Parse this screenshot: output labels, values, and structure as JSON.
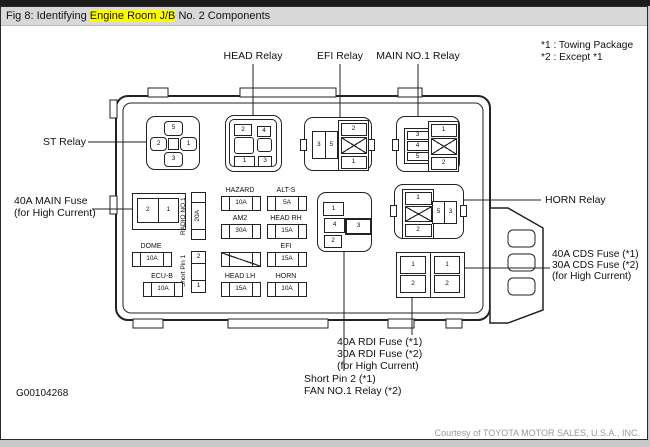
{
  "window": {
    "title_prefix": "Fig 8: Identifying ",
    "title_highlight": "Engine Room J/B",
    "title_suffix": " No. 2 Components"
  },
  "legend": {
    "line1": "*1 : Towing Package",
    "line2": "*2 : Except *1"
  },
  "callouts": {
    "head_relay": "HEAD Relay",
    "efi_relay": "EFI Relay",
    "main_no1_relay": "MAIN NO.1 Relay",
    "st_relay": "ST Relay",
    "main_fuse_line1": "40A MAIN Fuse",
    "main_fuse_line2": "(for High Current)",
    "horn_relay": "HORN Relay",
    "cds_line1": "40A CDS Fuse (*1)",
    "cds_line2": "30A CDS Fuse (*2)",
    "cds_line3": "(for High Current)",
    "rdi_line1": "40A RDI Fuse (*1)",
    "rdi_line2": "30A RDI Fuse (*2)",
    "rdi_line3": "(for High Current)",
    "short_pin2_line1": "Short Pin 2 (*1)",
    "short_pin2_line2": "FAN NO.1 Relay (*2)"
  },
  "fuses": {
    "hazard": {
      "label": "HAZARD",
      "amps": "10A"
    },
    "alt_s": {
      "label": "ALT-S",
      "amps": "5A"
    },
    "am2": {
      "label": "AM2",
      "amps": "30A"
    },
    "head_rh": {
      "label": "HEAD RH",
      "amps": "15A"
    },
    "efi": {
      "label": "EFI",
      "amps": "15A"
    },
    "head_lh": {
      "label": "HEAD LH",
      "amps": "15A"
    },
    "horn": {
      "label": "HORN",
      "amps": "10A"
    },
    "dome": {
      "label": "DOME",
      "amps": "10A"
    },
    "ecu_b": {
      "label": "ECU-B",
      "amps": "10A"
    },
    "radio_no1": {
      "label": "RADIO NO.1",
      "amps": "20A"
    },
    "short_pin1": {
      "label": "Short Pin 1",
      "pin_top": "2",
      "pin_bottom": "1"
    },
    "main": {
      "pin_left": "2",
      "pin_right": "1"
    },
    "rdi": {
      "pin_top": "1",
      "pin_bottom": "2"
    },
    "cds": {
      "pin_top": "1",
      "pin_bottom": "2"
    }
  },
  "relays": {
    "st": {
      "top": "5",
      "left": "2",
      "right": "1",
      "bottom": "3"
    },
    "head": {
      "p2": "2",
      "p4": "4",
      "p1": "1",
      "p3": "3"
    },
    "efi": {
      "p3": "3",
      "p5": "5",
      "p2": "2",
      "p1": "1"
    },
    "main_no1": {
      "p3": "3",
      "p4": "4",
      "p5": "5",
      "p1": "1",
      "p2": "2"
    },
    "horn": {
      "p1": "1",
      "p2": "2",
      "p5": "5",
      "p3": "3"
    },
    "fan": {
      "p1": "1",
      "p4": "4",
      "p3": "3",
      "p2": "2"
    }
  },
  "footer": {
    "figure_code": "G00104268",
    "courtesy": "Courtesy of TOYOTA MOTOR SALES, U.S.A., INC."
  },
  "colors": {
    "highlight": "#ffff00",
    "line": "#222222",
    "titlebar_bg": "#d8d8d8"
  }
}
